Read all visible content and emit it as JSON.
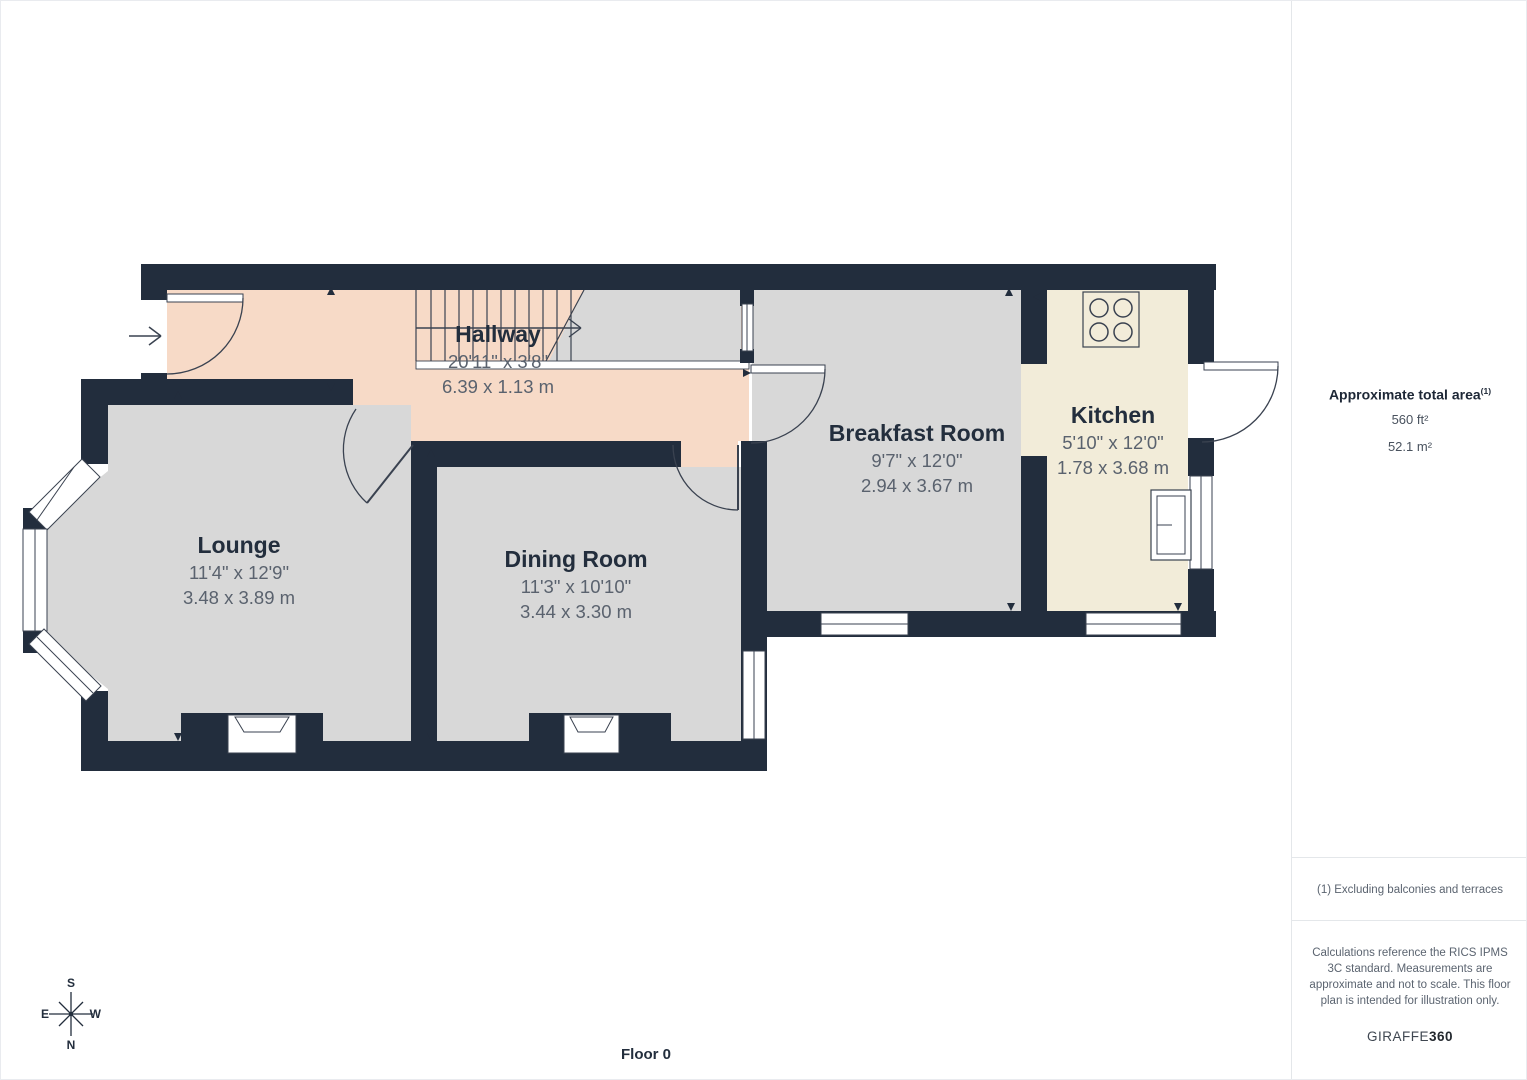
{
  "plan": {
    "floor_label": "Floor 0",
    "rooms": [
      {
        "name": "Hallway",
        "dim_ft": "20'11\" x 3'8\"",
        "dim_m": "6.39 x 1.13 m"
      },
      {
        "name": "Lounge",
        "dim_ft": "11'4\" x 12'9\"",
        "dim_m": "3.48 x 3.89 m"
      },
      {
        "name": "Dining Room",
        "dim_ft": "11'3\" x 10'10\"",
        "dim_m": "3.44 x 3.30 m"
      },
      {
        "name": "Breakfast Room",
        "dim_ft": "9'7\" x 12'0\"",
        "dim_m": "2.94 x 3.67 m"
      },
      {
        "name": "Kitchen",
        "dim_ft": "5'10\" x 12'0\"",
        "dim_m": "1.78 x 3.68 m"
      }
    ],
    "compass": {
      "top": "S",
      "left": "E",
      "right": "W",
      "bottom": "N"
    },
    "icons": {
      "stove": "4-ring hob square",
      "sink": "basin rectangle",
      "compass": "8-point star",
      "entrance": "right arrow",
      "stairs": "treads with up-direction arrow"
    }
  },
  "sidebar": {
    "area_title": "Approximate total area",
    "area_superscript": "(1)",
    "area_ft": "560 ft²",
    "area_m": "52.1 m²",
    "footnote": "(1) Excluding balconies and terraces",
    "disclaimer": "Calculations reference the RICS IPMS 3C standard. Measurements are approximate and not to scale. This floor plan is intended for illustration only.",
    "brand_name": "GIRAFFE",
    "brand_number": "360"
  },
  "colors": {
    "wall": "#222d3d",
    "room_fill": "#d8d8d8",
    "hallway_fill": "#f7dac7",
    "kitchen_fill": "#f2ecd9",
    "line": "#3a4250"
  }
}
